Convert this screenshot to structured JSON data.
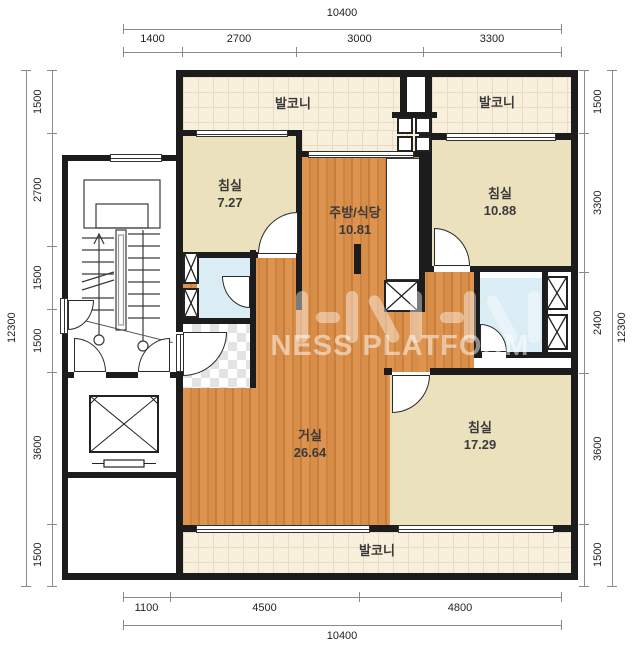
{
  "watermark": {
    "text": "NESS PLATFORM"
  },
  "rooms": {
    "balcony_top_left": {
      "label": "발코니"
    },
    "balcony_top_right": {
      "label": "발코니"
    },
    "balcony_bottom": {
      "label": "발코니"
    },
    "bedroom_small": {
      "label": "침실",
      "area": "7.27"
    },
    "kitchen_dining": {
      "label": "주방/식당",
      "area": "10.81"
    },
    "bedroom_right": {
      "label": "침실",
      "area": "10.88"
    },
    "living_room": {
      "label": "거실",
      "area": "26.64"
    },
    "bedroom_master": {
      "label": "침실",
      "area": "17.29"
    }
  },
  "dimensions": {
    "top": {
      "total": "10400",
      "segments": [
        "1400",
        "2700",
        "3000",
        "3300"
      ]
    },
    "bottom": {
      "total": "10400",
      "segments": [
        "1100",
        "4500",
        "4800"
      ]
    },
    "left": {
      "total": "12300",
      "segments": [
        "1500",
        "2700",
        "1500",
        "1500",
        "3600",
        "1500"
      ]
    },
    "right": {
      "total": "12300",
      "segments": [
        "1500",
        "3300",
        "2400",
        "3600",
        "1500"
      ]
    }
  },
  "colors": {
    "wall": "#1c1c1c",
    "wood_floor": "#d68b48",
    "bedroom_floor": "#ece1bd",
    "balcony_floor": "#f8f0dd",
    "bath_floor": "#daecf4"
  }
}
